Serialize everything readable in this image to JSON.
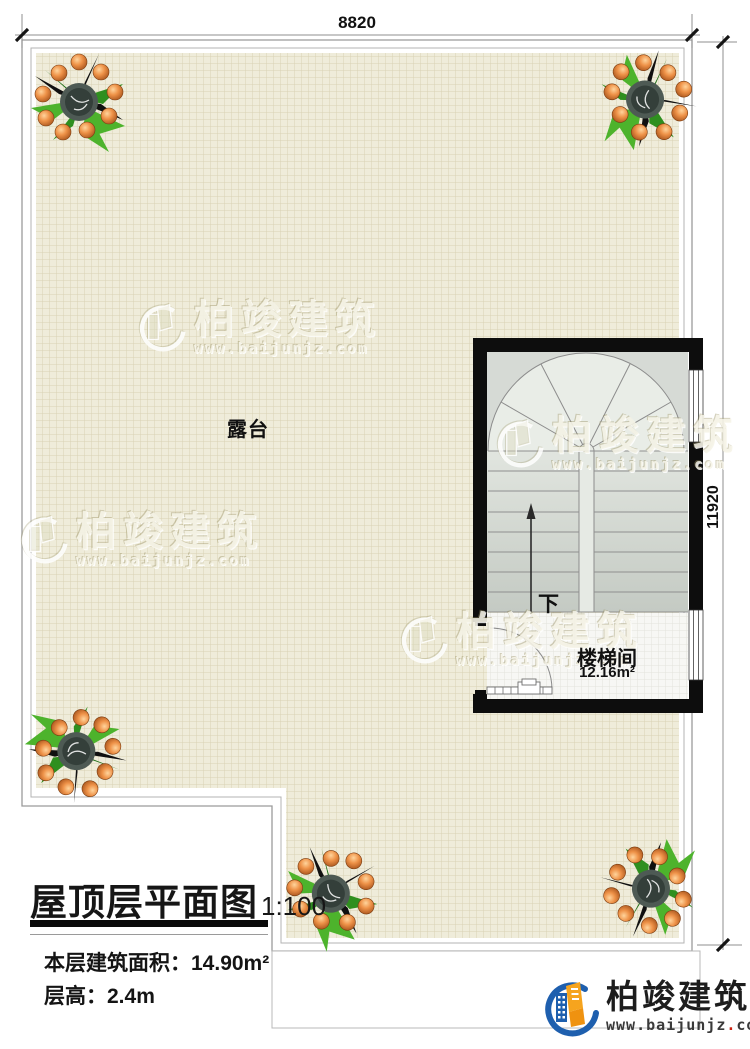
{
  "dimensions": {
    "top": "8820",
    "right": "11920"
  },
  "plan": {
    "terrace": {
      "label": "露台"
    },
    "stair_room": {
      "label": "楼梯间",
      "area": "12.16m²",
      "direction_label": "下"
    }
  },
  "title_block": {
    "title": "屋顶层平面图",
    "scale": "1:100",
    "specs": [
      {
        "label": "本层建筑面积：",
        "value": "14.90m²"
      },
      {
        "label": "层高：",
        "value": "2.4m"
      }
    ]
  },
  "branding": {
    "logo_name": "柏竣建筑",
    "logo_url_prefix": "www.baijunjz",
    "logo_url_dot": ".",
    "logo_url_suffix": "com",
    "watermark_name": "柏竣建筑",
    "watermark_url": "www.baijunjz.com"
  },
  "colors": {
    "wall": "#0d0d0d",
    "terrace_fill": "#efecda",
    "terrace_grid": "#d5cfae",
    "stair_fill": "#e7ebe5",
    "flight_dark": "#c6ccc5",
    "line_gray": "#8f8f8f",
    "brand_blue": "#1e5fae",
    "brand_orange": "#f6a41e",
    "accent_red": "#cc2211"
  }
}
